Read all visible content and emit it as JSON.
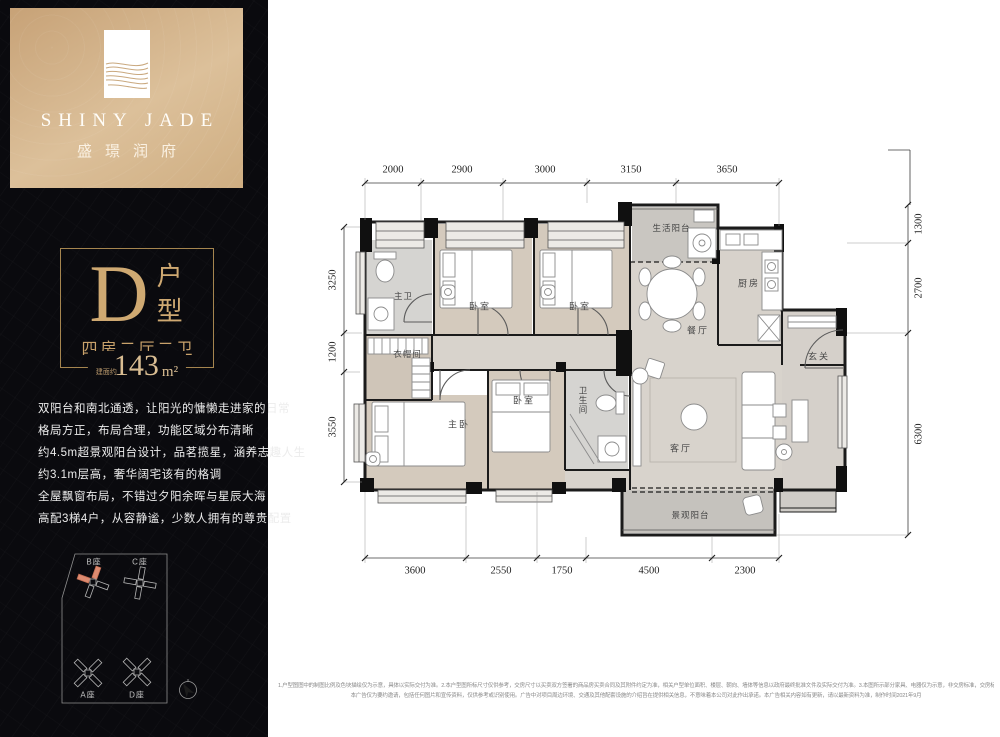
{
  "brand": {
    "name_en": "SHINY JADE",
    "name_cn": "盛璟润府"
  },
  "unit_card": {
    "letter": "D",
    "type_label": "户型",
    "rooms_label": "四房二厅二卫",
    "area_prefix": "建面约",
    "area_value": "143",
    "area_unit": "m²"
  },
  "description_lines": [
    "双阳台和南北通透，让阳光的慵懒走进家的日常",
    "格局方正，布局合理，功能区域分布清晰",
    "约4.5m超景观阳台设计，品茗揽星，涵养志趣人生",
    "约3.1m层高，奢华阔宅该有的格调",
    "全屋飘窗布局，不错过夕阳余晖与星辰大海",
    "高配3梯4户，从容静谧，少数人拥有的尊贵配置"
  ],
  "site_plan": {
    "buildings": [
      {
        "label": "B座",
        "highlighted": true
      },
      {
        "label": "C座",
        "highlighted": false
      },
      {
        "label": "A座",
        "highlighted": false
      },
      {
        "label": "D座",
        "highlighted": false
      }
    ]
  },
  "floor_plan": {
    "rooms": {
      "master_bath": "主卫",
      "bedroom_top_a": "卧室",
      "bedroom_top_b": "卧室",
      "life_balcony": "生活阳台",
      "kitchen": "厨房",
      "dining": "餐厅",
      "foyer": "玄关",
      "cloakroom": "衣帽间",
      "master_bedroom": "主卧",
      "bedroom_bottom": "卧室",
      "bathroom": "卫生间",
      "living": "客厅",
      "view_balcony": "景观阳台"
    },
    "dims_top": [
      "2000",
      "2900",
      "3000",
      "3150",
      "3650"
    ],
    "dims_bottom": [
      "3600",
      "2550",
      "1750",
      "4500",
      "2300"
    ],
    "dims_left": [
      "3250",
      "1200",
      "3550"
    ],
    "dims_right": [
      "1300",
      "2700",
      "6300"
    ]
  },
  "disclaimer_lines": [
    "1.户型图图中的制图比例及色块描绘仅为示意，具体以实际交付为准。2.本户型图所标尺寸仅供参考，交房尺寸以买卖双方签署的商品房买卖合同及其附件约定为准，相关户型单位面积、楼层、朝向、墙体等信息以政府最终批准文件及实际交付为准。3.本图所示部分家具、电器仅为示意，非交房标准，交房标准以合同约定为准。4.本户型图仅为楼盘示意图，意在展示户型结构布局。",
    "本广告仅为要约邀请，包括任何图片和宣传资料，仅供参考或识别使用。广告中对项目周边环境、交通及其他配套设施的介绍旨在提供相关信息，不意味着本公司对此作出承诺。本广告相关内容如有更新，请以最新资料为准，制作时间2021年9月"
  ],
  "colors": {
    "gold": "#c9a26b",
    "gold_light": "#d9bd92",
    "panel_bg": "#0a0a0e",
    "header_gradient_start": "#c7a277",
    "header_gradient_end": "#dcc09a",
    "highlight_red": "#dd8b70",
    "wall": "#1b1b1b"
  }
}
